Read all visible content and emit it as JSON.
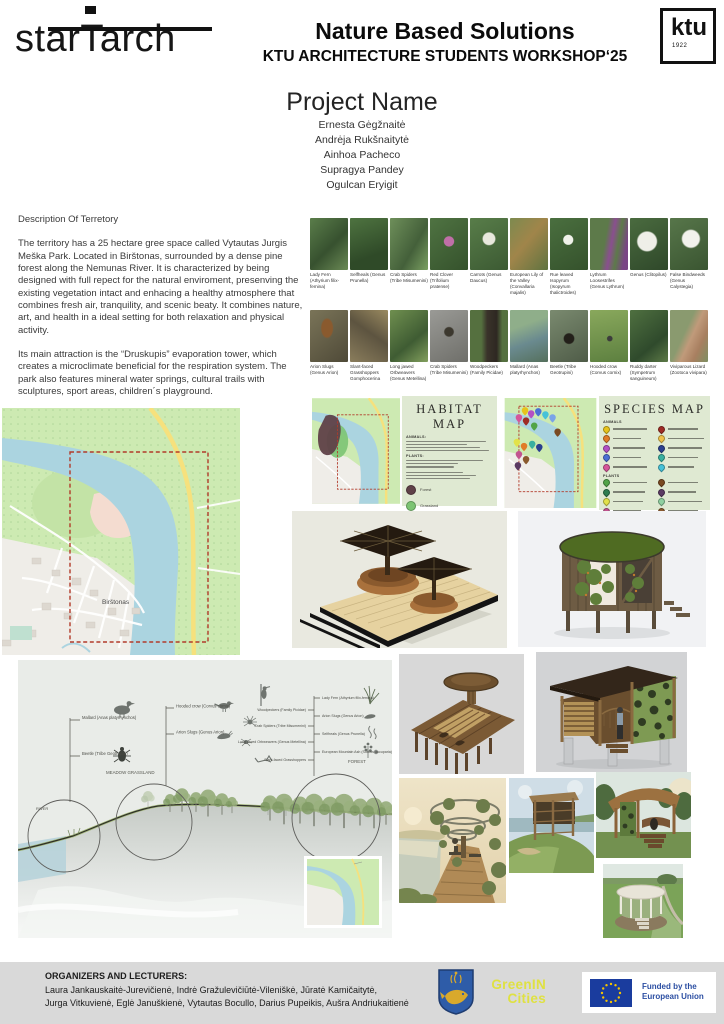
{
  "header": {
    "studio_logo": "starTarch",
    "title": "Nature Based Solutions",
    "subtitle": "KTU ARCHITECTURE STUDENTS WORKSHOP‘25",
    "ktu": {
      "label": "ktu",
      "year": "1922"
    }
  },
  "project": {
    "title": "Project Name",
    "members": [
      "Ernesta Gėgžnaitė",
      "Andrėja Rukšnaitytė",
      "Ainhoa Pacheco",
      "Supragya Pandey",
      "Ogulcan Eryigit"
    ]
  },
  "description": {
    "heading": "Description Of Terretory",
    "paragraph1": "The territory has a 25 hectare gree space  called Vytautas Jurgis Meška Park. Located in Birštonas, surrounded by a dense pine forest along the Nemunas River.  It is characterized by being designed with full repect for the natural enviroment, presenving the existing vegetation intact and enhacing a healthy atmosphere that combines fresh air, tranquility, and scenic beaty. It combines nature, art, and health in a ideal setting for both relaxation and physical  activity.",
    "paragraph2": "Its main attraction is the “Druskupis” evaporation tower, which creates a microclimate beneficial for the  respiration system. The park also features mineral water springs, cultural trails with sculptures, sport areas, children´s playground."
  },
  "species_grid": {
    "row1": [
      "Lady Fern (Athyrium filix-femina)",
      "Selfheals (Genus Prunella)",
      "Crab Spiders (Tribe Misumenini)",
      "Red Clover (Trifolium pratense)",
      "Carrots (Genus Daucus)",
      "European Lily of the Valley (Convallaria majalis)",
      "Rue leaved Isopyrum (Isopyrum thalictroides)",
      "Lythrum Loosestrifes (Genus Lythrum)",
      "Genus (Clitopilus)",
      "False Bindweeds (Genus Calystegia)"
    ],
    "row2": [
      "Arion Slugs (Genus Arion)",
      "Slant-faced Grasshoppers Gomphocerina",
      "Long jawed Orbweavers (Genus Metellina)",
      "Crab Spiders (Tribe Misumenini)",
      "Woodpeckers (Family Picidae)",
      "Mallard (Anas platyrhynchos)",
      "Beetle (Tribe Geotrupini)",
      "Hooded crow (Corvus cornix)",
      "Ruddy darter (Sympetrum sanguineum)",
      "Viviparous Lizard (Zootoca vivipara)"
    ]
  },
  "habitat_map": {
    "title": "HABITAT MAP",
    "animals_heading": "ANIMALS:",
    "plants_heading": "PLANTS:",
    "legend": [
      {
        "color": "#5f4148",
        "label": "Forest"
      },
      {
        "color": "#7cc473",
        "label": "Grassland"
      },
      {
        "color": "#8fb4e3",
        "label": "River"
      }
    ]
  },
  "species_map": {
    "title": "SPECIES MAP",
    "animals_heading": "ANIMALS",
    "plants_heading": "PLANTS"
  },
  "location_map": {
    "town_label": "Birštonas"
  },
  "section_diagram": {
    "zones": {
      "river": "RIVER",
      "meadow": "MEADOW GRASSLAND",
      "forest": "FOREST"
    },
    "left_labels": [
      "Mallard (Anas platyrhynchos)",
      "Beetle (Tribe Geotrupini)"
    ],
    "middle_labels": [
      "Hooded crow (Corvus cornix)",
      "Arion Slugs (Genus Arion)"
    ],
    "right_col1": [
      "Woodpeckers (Family Picidae)",
      "Crab Spiders (Tribe Misumenini)",
      "Long jawed Orbweavers (Genus Metellina)",
      "Slant-faced Grasshoppers"
    ],
    "right_col2": [
      "Lady Fern (Athyrium filix-femina)",
      "Arion Slugs (Genus Arion)",
      "Selfheals (Genus Prunella)",
      "European Mountain Ash (Sorbus aucuparia)"
    ]
  },
  "footer": {
    "heading": "ORGANIZERS AND LECTURERS:",
    "line1": "Laura Jankauskaitė-Jurevičienė,  Indrė Gražulevičiūtė-Vileniškė, Jūratė Kamičaitytė,",
    "line2": "Jurga Vitkuvienė,  Eglė Januškienė, Vytautas Bocullo, Darius Pupeikis, Aušra Andriukaitienė",
    "greenin_line1": "GreenIN",
    "greenin_line2": "Cities",
    "eu_line1": "Funded by the",
    "eu_line2": "European Union",
    "colors": {
      "greenin": "#dfe142",
      "eu_blue": "#2b4ea2",
      "eu_flag": "#1a3c9e",
      "eu_star": "#f5c400"
    }
  }
}
